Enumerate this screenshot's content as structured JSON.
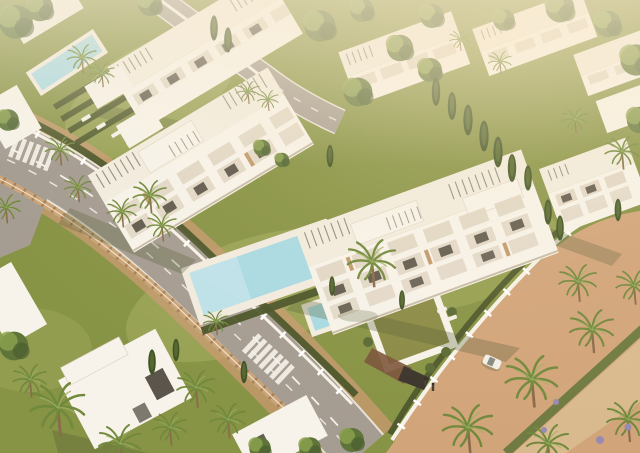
{
  "scene": {
    "description": "Aerial 3D architectural rendering of a white modern Mediterranean apartment complex with a turquoise swimming pool, palm trees, lawns, white perimeter fences and curving asphalt roads in warm sunset light",
    "image_type": "architectural-render",
    "view": "aerial oblique",
    "lighting": "warm low sun from upper right, hazy highlights on white buildings",
    "inventory": {
      "buildings": [
        "top-left apartment block with rooftop pergolas",
        "left-center apartment block with balconies and roof terraces",
        "right-center foreground apartment block with pergola roof terraces and glass balconies",
        "top-right cluster of white apartment blocks",
        "right-edge apartment block",
        "bottom-left modern villa under palm canopy",
        "small white villa bottom-center"
      ],
      "pools": [
        "large rectangular communal pool with cream deck and sun loungers",
        "small square plunge pool beside main pool",
        "narrow lap pool in top-left garden"
      ],
      "roads": [
        "curving asphalt road with dashed white lane markings from left edge to bottom center",
        "two zebra pedestrian crossings",
        "narrow asphalt road at top center between blocks",
        "terracotta paved promenade with palm trees in bottom-right corner",
        "sandy pedestrian path crossing the promenade diagonally"
      ],
      "landscape": [
        "olive-green lawns",
        "dark clipped hedges along white fences",
        "tall cypress trees between buildings",
        "many palm trees",
        "green-roofed underground garage entrance with ramp",
        "terracotta balustrade wall along the road"
      ],
      "objects": [
        "white car parked on promenade",
        "two pedestrians walking",
        "white sun loungers on decks and lawns"
      ]
    }
  },
  "palette": {
    "ground_green": "#879345",
    "lawn_light": "#a9b264",
    "hedge_dark": "#4a5429",
    "tree_green": "#5e7439",
    "tree_light": "#8aa04e",
    "cypress_dark": "#415426",
    "palm_green": "#71893d",
    "palm_light": "#9db265",
    "trunk_brown": "#8a6b4a",
    "road_asphalt": "#a59c92",
    "marking_white": "#f4f1e9",
    "terracotta": "#c99a72",
    "terracotta_light": "#d2a47a",
    "baluster_tan": "#caa478",
    "baluster_post": "#a57a50",
    "path_sand": "#d9ba8e",
    "fence_white": "#f6f2e8",
    "building_white": "#f7f3ea",
    "building_cream": "#f2ecdf",
    "building_shade": "#ddd2c0",
    "wood_accent": "#c19a6b",
    "window_dark": "#4a443a",
    "pergola_dark": "#7b7466",
    "pool_water": "#a9dae3",
    "pool_deck": "#f1ebdf",
    "roof_grass": "#8a8a45",
    "ramp_brown": "#7a5339",
    "garage_dark": "#3a342c",
    "car_white": "#f2efe8",
    "lavender": "#988ab0",
    "haze_warm": "#f8ecd7",
    "shadow_olive": "#4e5a33"
  }
}
